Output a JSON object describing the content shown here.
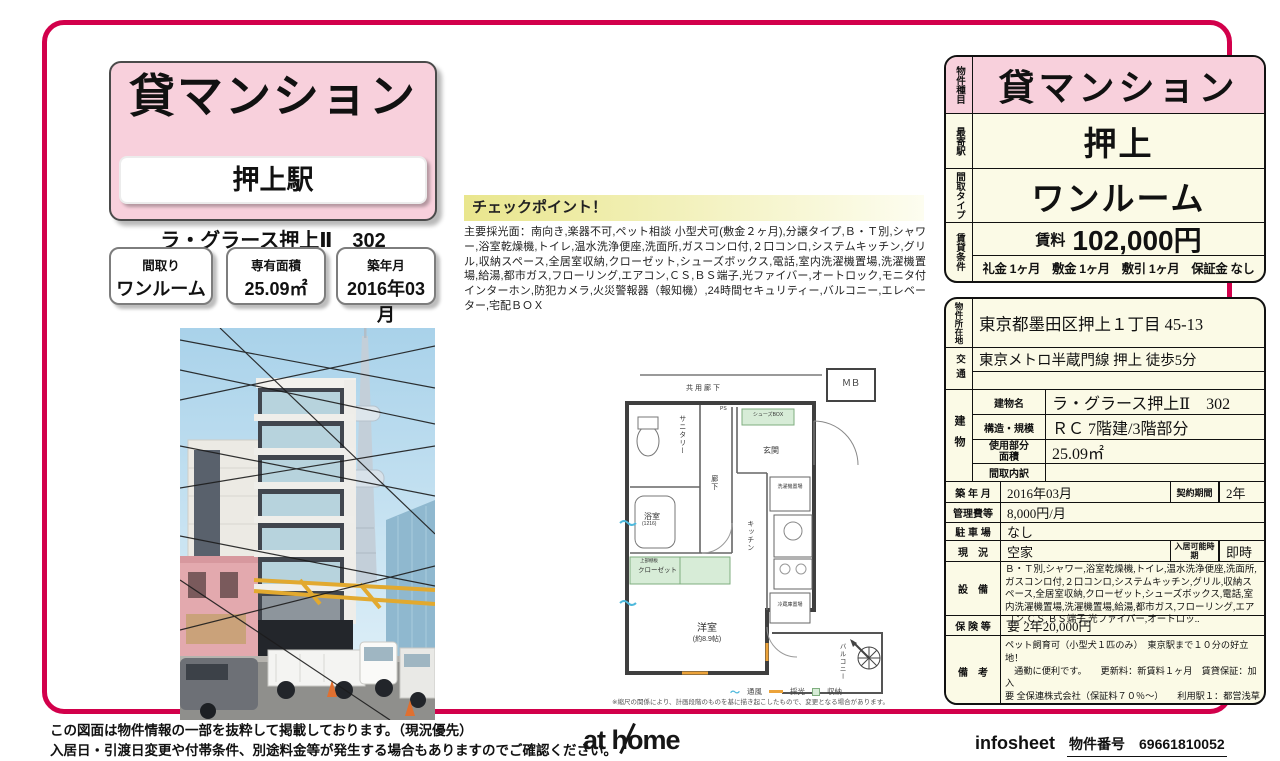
{
  "colors": {
    "accent": "#d2004b",
    "pink": "#f8d0dc",
    "cream": "#fbfae6"
  },
  "header": {
    "property_type": "貸マンション",
    "station": "押上駅",
    "building_line": "ラ・グラース押上Ⅱ　302",
    "spec_boxes": [
      {
        "label": "間取り",
        "value": "ワンルーム"
      },
      {
        "label": "専有面積",
        "value": "25.09㎡"
      },
      {
        "label": "築年月",
        "value": "2016年03月"
      }
    ]
  },
  "checkpoint": {
    "title": "チェックポイント！",
    "body": "主要採光面：南向き,楽器不可,ペット相談 小型犬可(敷金２ヶ月),分譲タイプ,Ｂ・Ｔ別,シャワー,浴室乾燥機,トイレ,温水洗浄便座,洗面所,ガスコンロ付,２口コンロ,システムキッチン,グリル,収納スペース,全居室収納,クローゼット,シューズボックス,電話,室内洗濯機置場,洗濯機置場,給湯,都市ガス,フローリング,エアコン,ＣＳ,ＢＳ端子,光ファイバー,オートロック,モニタ付インターホン,防犯カメラ,火災警報器（報知機）,24時間セキュリティー,バルコニー,エレベーター,宅配ＢＯＸ"
  },
  "floorplan": {
    "labels": {
      "corridor_common": "共用廊下",
      "mb": "ＭＢ",
      "sanitary": "サニタリー",
      "entrance": "玄関",
      "shoebox": "シューズBOX",
      "bath": "浴室",
      "bath_size": "(1216)",
      "hall": "廊下",
      "kitchen": "キッチン",
      "laundry": "洗濯機置場",
      "closet": "クローゼット",
      "closet_upper": "上部棚板",
      "fridge": "冷蔵庫置場",
      "room": "洋室",
      "room_size": "(約8.9帖)",
      "balcony": "バルコニー",
      "ps": "PS"
    },
    "legend": {
      "wind": "通風",
      "light": "採光",
      "storage": "収納"
    },
    "note": "※縮尺の関係により、計画段階のものを基に描き起こしたもので、変更となる場合があります。"
  },
  "summary": {
    "type_label": "物件種目",
    "type_value": "貸マンション",
    "station_label": "最寄駅",
    "station_value": "押上",
    "layout_label": "間取タイプ",
    "layout_value": "ワンルーム",
    "terms_label": "賃貸条件",
    "rent_label": "賃料",
    "rent_value": "102,000円",
    "terms_value": "礼金 1ヶ月　敷金 1ヶ月　敷引 1ヶ月　保証金 なし"
  },
  "detail": {
    "location_label": "物件所在地",
    "location": "東京都墨田区押上１丁目 45-13",
    "transport_label": "交通",
    "transport1": "東京メトロ半蔵門線 押上 徒歩5分",
    "transport2": "",
    "building_label": "建物",
    "name_label": "建物名",
    "name": "ラ・グラース押上Ⅱ　302",
    "structure_label": "構造・規模",
    "structure": "ＲＣ 7階建/3階部分",
    "area_label": "使用部分面積",
    "area": "25.09㎡",
    "layout_detail_label": "間取内訳",
    "layout_detail": "",
    "built_label": "築 年 月",
    "built": "2016年03月",
    "contract_label": "契約期間",
    "contract": "2年",
    "mgmt_label": "管理費等",
    "mgmt": "8,000円/月",
    "parking_label": "駐 車 場",
    "parking": "なし",
    "status_label": "現　況",
    "status": "空家",
    "movein_label": "入居可能時期",
    "movein": "即時",
    "equip_label": "設　備",
    "equipment": "Ｂ・Ｔ別,シャワー,浴室乾燥機,トイレ,温水洗浄便座,洗面所,ガスコンロ付,２口コンロ,システムキッチン,グリル,収納スペース,全居室収納,クローゼット,シューズボックス,電話,室内洗濯機置場,洗濯機置場,給湯,都市ガス,フローリング,エアコン,ＣＳ,ＢＳ端子,光ファイバー,オートロッ..",
    "insurance_label": "保 険 等",
    "insurance": "要 2年20,000円",
    "remarks_label": "備　考",
    "remarks": "ペット飼育可（小型犬１匹のみ）　東京駅まで１０分の好立地！\n　通勤に便利です。　　更新料：新賃料１ヶ月　賃貸保証：加入\n要 全保連株式会社（保証料７０％～）　　利用駅１：都営浅草線\n押上 徒歩6分　利用駅２：東武伊勢崎・大師線 とうきょうスカイツリー 徒歩10分"
  },
  "footer": {
    "disclaimer1": "この図面は物件情報の一部を抜粋して掲載しております。（現況優先）",
    "disclaimer2": "入居日・引渡日変更や付帯条件、別途料金等が発生する場合もありますのでご確認ください。",
    "logo": "at home",
    "infosheet": "infosheet",
    "property_no_label": "物件番号",
    "property_no": "69661810052"
  }
}
